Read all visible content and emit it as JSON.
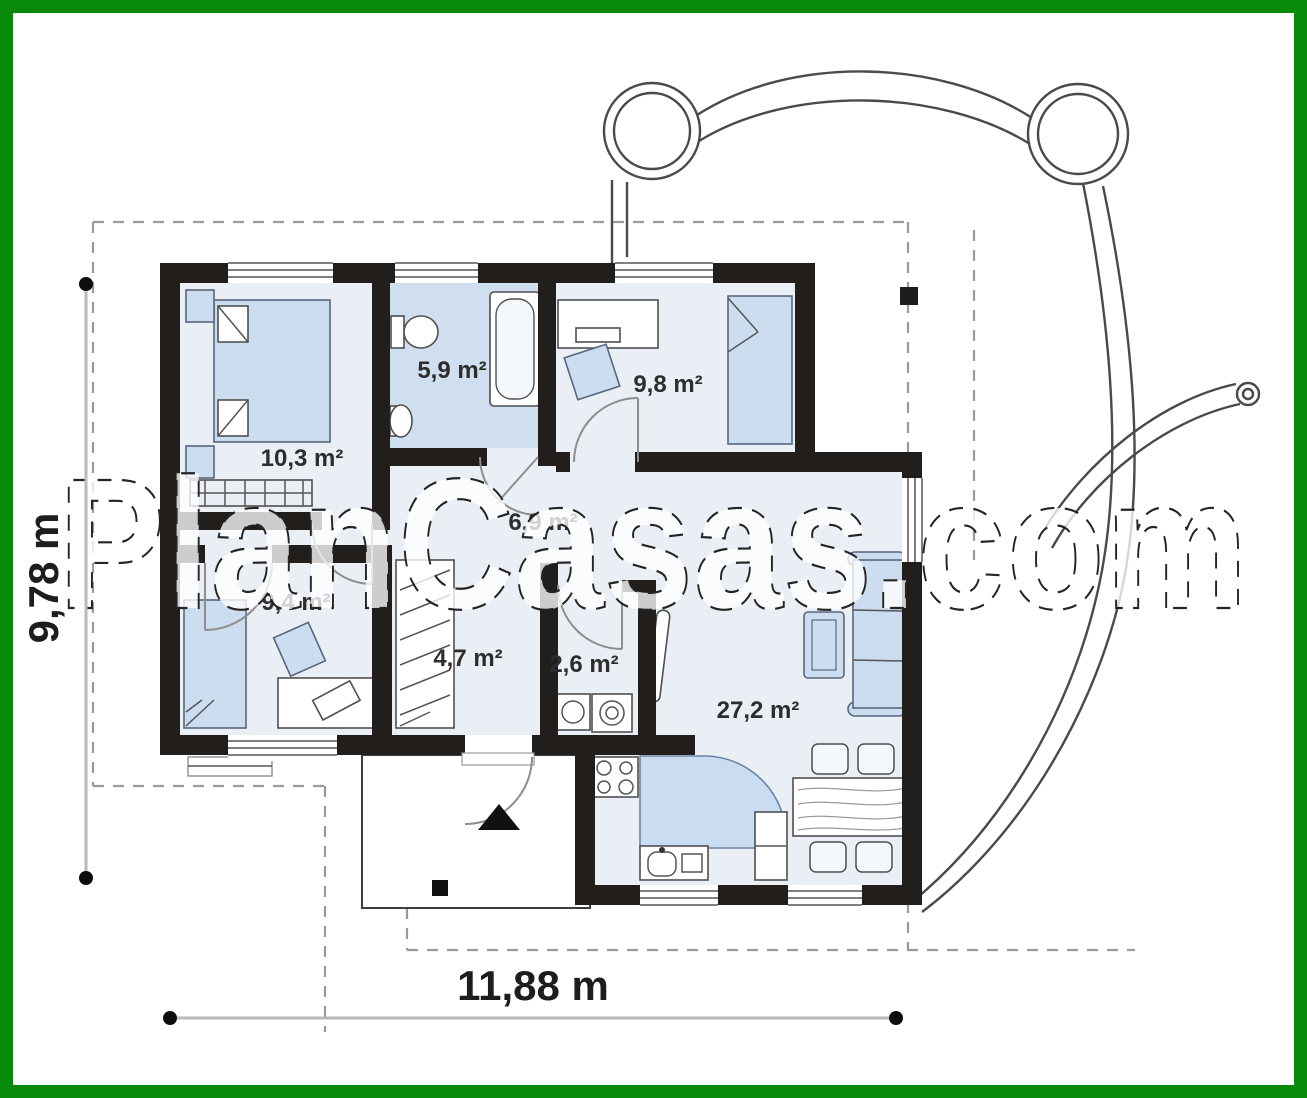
{
  "watermark": {
    "text": "PlanCasas.com"
  },
  "dimensions": {
    "width_label": "11,88 m",
    "height_label": "9,78 m"
  },
  "rooms": [
    {
      "name": "bedroom-1",
      "label": "10,3 m²"
    },
    {
      "name": "bathroom",
      "label": "5,9 m²"
    },
    {
      "name": "bedroom-2",
      "label": "9,8 m²"
    },
    {
      "name": "hall",
      "label": "6,9 m²"
    },
    {
      "name": "bedroom-3",
      "label": "9,4 m²"
    },
    {
      "name": "corridor",
      "label": "4,7 m²"
    },
    {
      "name": "wc-laundry",
      "label": "2,6 m²"
    },
    {
      "name": "living-kitchen",
      "label": "27,2 m²"
    }
  ],
  "colors": {
    "frame_green": "#0a8a0a",
    "wall_black": "#221e1b",
    "room_fill": "#eaeff6",
    "bathroom_fill": "#cfdfef",
    "furniture_fill": "#cdddf0",
    "counter_fill": "#c9dcf1",
    "dashed_boundary": "#9a9a9a"
  }
}
